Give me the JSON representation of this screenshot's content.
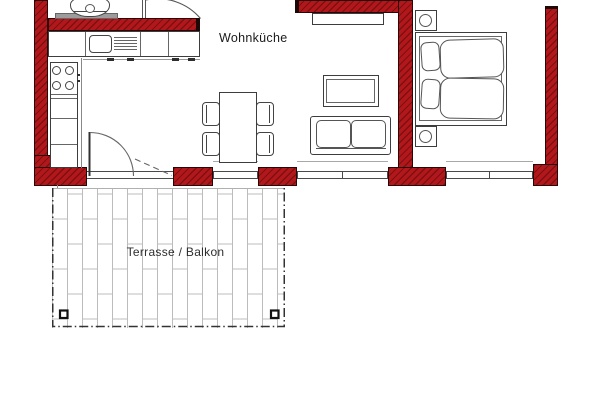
{
  "title": "apartment-floor-plan",
  "labels": {
    "living_kitchen": "Wohnküche",
    "terrace": "Terrasse / Balkon"
  },
  "colors": {
    "wall_fill": "#b2181b",
    "wall_hatch": "#6b0b0d",
    "wall_outline": "#2a0707",
    "furniture_outline": "#3d3d3d",
    "tile_joint": "#bcbcbc",
    "terrace_border": "#333333",
    "counter_gray": "#9c9c9c",
    "text_color": "#1b1b1b"
  },
  "rooms": [
    {
      "id": "wohnkueche",
      "label": "Wohnküche",
      "features": [
        "kitchen-counter",
        "sink",
        "drainer",
        "stove",
        "dining-table",
        "chairs",
        "sofa",
        "coffee-table",
        "sideboard",
        "balcony-door",
        "windows"
      ]
    },
    {
      "id": "schlafbereich",
      "label": "",
      "features": [
        "double-bed",
        "nightstand-top",
        "nightstand-bottom",
        "window"
      ]
    },
    {
      "id": "terrasse",
      "label": "Terrasse / Balkon",
      "features": [
        "tiled-floor",
        "corner-posts",
        "dashed-boundary"
      ]
    }
  ]
}
